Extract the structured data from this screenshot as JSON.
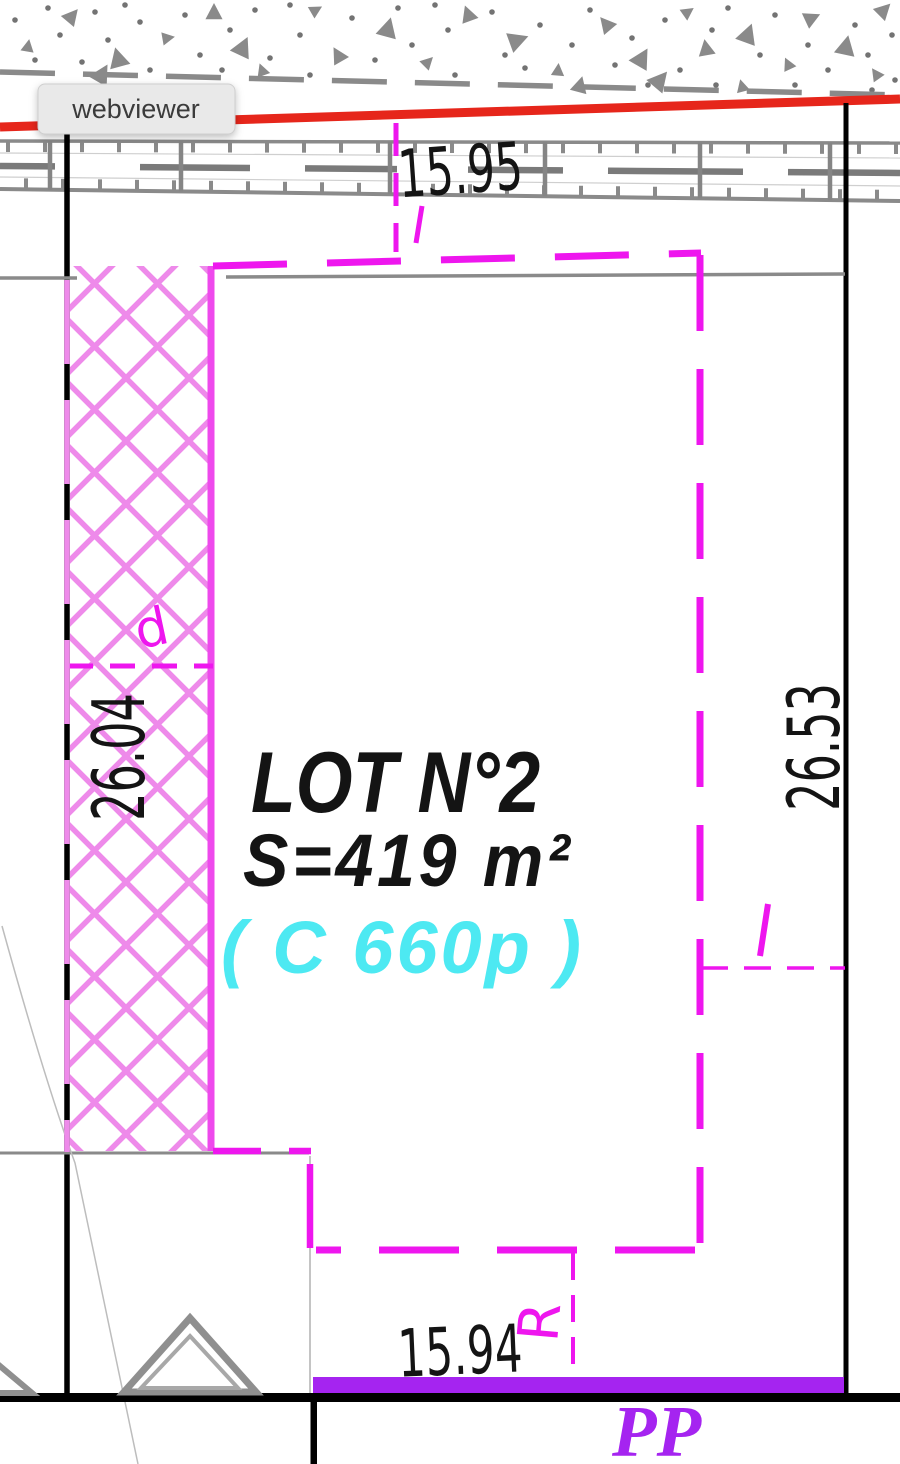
{
  "viewer": {
    "label": "webviewer"
  },
  "plan": {
    "lot": {
      "title": "LOT N°2",
      "area": "S=419 m²",
      "capacity": "( C 660p )"
    },
    "dimensions": {
      "top": "15.95",
      "left": "26.04",
      "right": "26.53",
      "bottom": "15.94"
    },
    "marks": {
      "door": "d",
      "r": "R",
      "pp": "PP"
    },
    "colors": {
      "boundary_magenta": "#EE16EE",
      "hatch_pink": "#EE8AEA",
      "area_cyan": "#4DE9F2",
      "pp_purple": "#A524F0",
      "road_red": "#E6261B",
      "line_gray": "#8A8A8A",
      "ink_black": "#141414"
    }
  }
}
